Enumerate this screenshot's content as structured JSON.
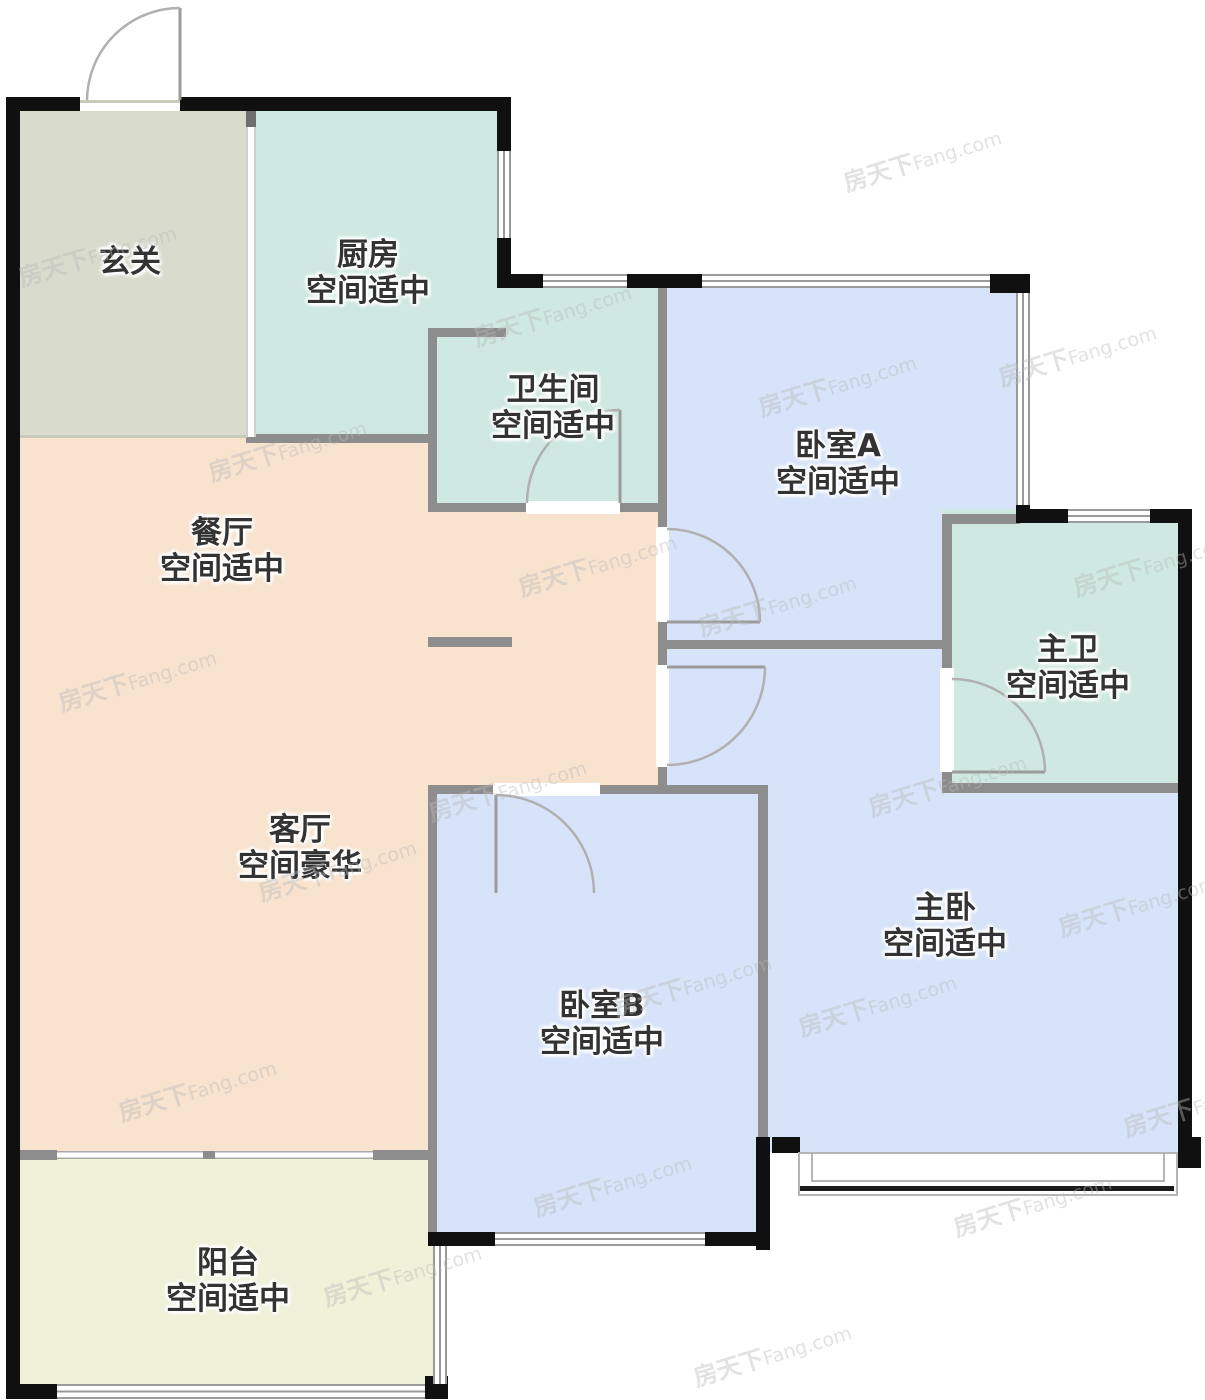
{
  "watermark": {
    "brand_cn": "房天下",
    "brand_en": "Fang.com"
  },
  "rooms": [
    {
      "id": "foyer",
      "name": "玄关",
      "size_note": "",
      "cx": 130,
      "cy": 262
    },
    {
      "id": "kitchen",
      "name": "厨房",
      "size_note": "空间适中",
      "cx": 368,
      "cy": 273
    },
    {
      "id": "bathroom",
      "name": "卫生间",
      "size_note": "空间适中",
      "cx": 553,
      "cy": 408
    },
    {
      "id": "bedroom-a",
      "name": "卧室A",
      "size_note": "空间适中",
      "cx": 838,
      "cy": 464
    },
    {
      "id": "dining",
      "name": "餐厅",
      "size_note": "空间适中",
      "cx": 222,
      "cy": 551
    },
    {
      "id": "master-bath",
      "name": "主卫",
      "size_note": "空间适中",
      "cx": 1068,
      "cy": 668
    },
    {
      "id": "living",
      "name": "客厅",
      "size_note": "空间豪华",
      "cx": 300,
      "cy": 848
    },
    {
      "id": "master-bed",
      "name": "主卧",
      "size_note": "空间适中",
      "cx": 945,
      "cy": 926
    },
    {
      "id": "bedroom-b",
      "name": "卧室B",
      "size_note": "空间适中",
      "cx": 602,
      "cy": 1024
    },
    {
      "id": "balcony",
      "name": "阳台",
      "size_note": "空间适中",
      "cx": 228,
      "cy": 1281
    }
  ],
  "colors": {
    "foyer": "#d9dbcd",
    "kitchen_bath": "#cfe8e1",
    "bedroom": "#d6e3f8",
    "living_dining": "#f7e3ce",
    "balcony": "#eff1d9",
    "exterior_wall": "#101010",
    "interior_wall": "#8d8d8d",
    "door_arc": "#b0b0b0",
    "label_text": "#333333"
  }
}
